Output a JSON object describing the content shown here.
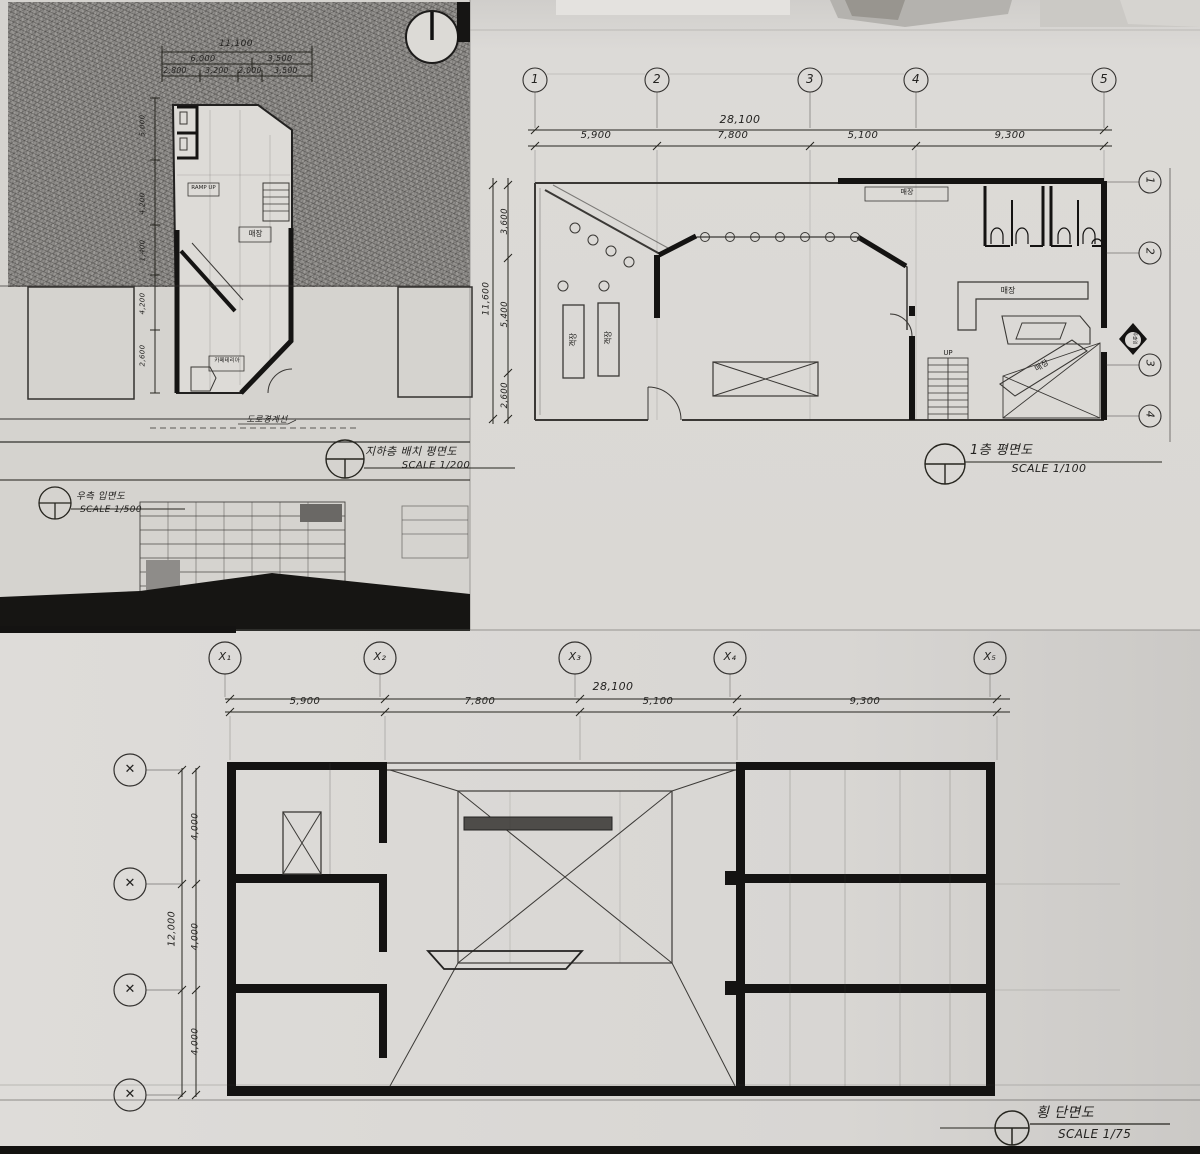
{
  "site_plan": {
    "title": "지하층 배치 평면도",
    "scale": "SCALE 1/200",
    "dim_total": "11,100",
    "dims_row2": [
      "6,000",
      "3,500"
    ],
    "dims_row3": [
      "2,800",
      "3,200",
      "2,000",
      "3,500"
    ],
    "dims_left": [
      "5,000",
      "4,200",
      "1,400",
      "4,200",
      "2,600"
    ],
    "labels": {
      "ramp": "RAMP UP",
      "store": "매장",
      "cafeteria": "카페테리아",
      "road": "도로경계선"
    }
  },
  "elevation": {
    "title": "우측 입면도",
    "scale": "SCALE 1/500"
  },
  "floor_plan": {
    "title": "1층 평면도",
    "scale": "SCALE 1/100",
    "grid_top": [
      "1",
      "2",
      "3",
      "4",
      "5"
    ],
    "grid_right": [
      "1",
      "2",
      "3",
      "4"
    ],
    "dim_total": "28,100",
    "dims": [
      "5,900",
      "7,800",
      "5,100",
      "9,300"
    ],
    "vdim_total": "11,600",
    "vdims": [
      "3,600",
      "5,400",
      "2,600"
    ],
    "labels": {
      "store_top": "매장",
      "case1": "객장",
      "case2": "객장",
      "counter1": "매장",
      "counter2": "매장",
      "up": "UP",
      "entrance": "주출입"
    }
  },
  "section": {
    "title": "횡 단면도",
    "scale": "SCALE 1/75",
    "grid_top": [
      "X₁",
      "X₂",
      "X₃",
      "X₄",
      "X₅"
    ],
    "left_marks": [
      "✕",
      "✕",
      "✕",
      "✕"
    ],
    "dim_total": "28,100",
    "dims": [
      "5,900",
      "7,800",
      "5,100",
      "9,300"
    ],
    "vdim_total": "12,000",
    "vdims": [
      "4,000",
      "4,000",
      "4,000"
    ]
  }
}
